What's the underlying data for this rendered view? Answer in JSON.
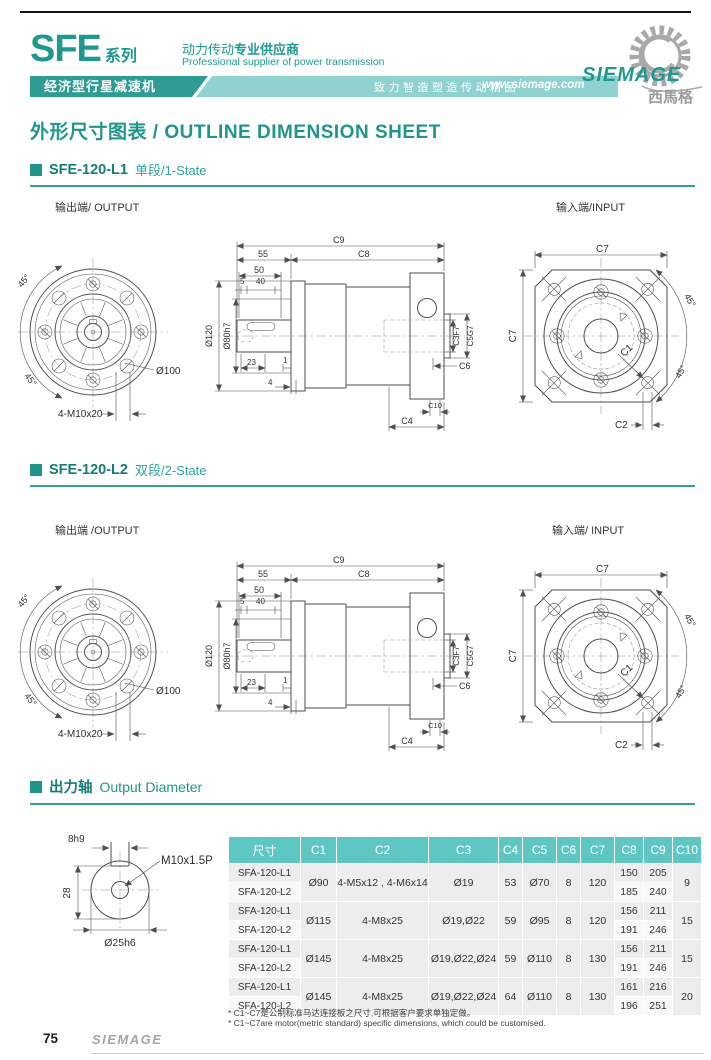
{
  "header": {
    "series": "SFE",
    "series_suffix": "系列",
    "tagline_cn_a": "动力传动",
    "tagline_cn_b": "专业供应商",
    "tagline_en": "Professional supplier of power transmission",
    "banner_left": "经济型行星减速机",
    "banner_slogan": "致力智造塑造传动精品",
    "banner_url": "www.siemage.com",
    "logo_text": "SIEMAGE",
    "logo_cn": "西馬格"
  },
  "page_title": "外形尺寸图表 / OUTLINE DIMENSION SHEET",
  "sections": {
    "s1": {
      "name": "SFE-120-L1",
      "state": "单段/1-State",
      "out": "输出端/ OUTPUT",
      "in": "输入端/INPUT"
    },
    "s2": {
      "name": "SFE-120-L2",
      "state": "双段/2-State",
      "out": "输出端 /OUTPUT",
      "in": "输入端/ INPUT"
    },
    "s3": {
      "title_cn": "出力轴",
      "title_en": "Output Diameter"
    }
  },
  "dw": {
    "a45": "45°",
    "d100": "Ø100",
    "m10": "4-M10x20",
    "c9": "C9",
    "c8": "C8",
    "n55": "55",
    "n50": "50",
    "n5": "5",
    "n40": "40",
    "d120": "Ø120",
    "d80": "Ø80h7",
    "n23": "23",
    "n1": "1",
    "n4": "4",
    "c3": "C3F7",
    "c5": "C5G7",
    "c6": "C6",
    "c10": "C10",
    "c4": "C4",
    "c7": "C7",
    "c1": "C1",
    "c2": "C2"
  },
  "shaft": {
    "key": "8h9",
    "h": "28",
    "thread": "M10x1.5P",
    "dia": "Ø25h6"
  },
  "table": {
    "headers": [
      "尺寸",
      "C1",
      "C2",
      "C3",
      "C4",
      "C5",
      "C6",
      "C7",
      "C8",
      "C9",
      "C10"
    ],
    "groups": [
      {
        "models": [
          "SFA-120-L1",
          "SFA-120-L2"
        ],
        "c1": "Ø90",
        "c2": "4-M5x12 , 4-M6x14",
        "c3": "Ø19",
        "c4": "53",
        "c5": "Ø70",
        "c6": "8",
        "c7": "120",
        "c8": [
          "150",
          "185"
        ],
        "c9": [
          "205",
          "240"
        ],
        "c10": "9"
      },
      {
        "models": [
          "SFA-120-L1",
          "SFA-120-L2"
        ],
        "c1": "Ø115",
        "c2": "4-M8x25",
        "c3": "Ø19,Ø22",
        "c4": "59",
        "c5": "Ø95",
        "c6": "8",
        "c7": "120",
        "c8": [
          "156",
          "191"
        ],
        "c9": [
          "211",
          "246"
        ],
        "c10": "15"
      },
      {
        "models": [
          "SFA-120-L1",
          "SFA-120-L2"
        ],
        "c1": "Ø145",
        "c2": "4-M8x25",
        "c3": "Ø19,Ø22,Ø24",
        "c4": "59",
        "c5": "Ø110",
        "c6": "8",
        "c7": "130",
        "c8": [
          "156",
          "191"
        ],
        "c9": [
          "211",
          "246"
        ],
        "c10": "15"
      },
      {
        "models": [
          "SFA-120-L1",
          "SFA-120-L2"
        ],
        "c1": "Ø145",
        "c2": "4-M8x25",
        "c3": "Ø19,Ø22,Ø24",
        "c4": "64",
        "c5": "Ø110",
        "c6": "8",
        "c7": "130",
        "c8": [
          "161",
          "196"
        ],
        "c9": [
          "216",
          "251"
        ],
        "c10": "20"
      }
    ],
    "notes": [
      "* C1~C7是公制标准马达连接板之尺寸,可根据客户要求单独定做。",
      "* C1~C7are motor(metric standard)  specific dimensions, which could be customised."
    ]
  },
  "footer": {
    "page": "75",
    "brand": "SIEMAGE"
  },
  "colors": {
    "teal": "#1f958b",
    "banner_dark": "#2e9c93",
    "banner_light": "#8fd2cf",
    "table_header": "#5ec7c4",
    "row_alt": "#ededed"
  }
}
